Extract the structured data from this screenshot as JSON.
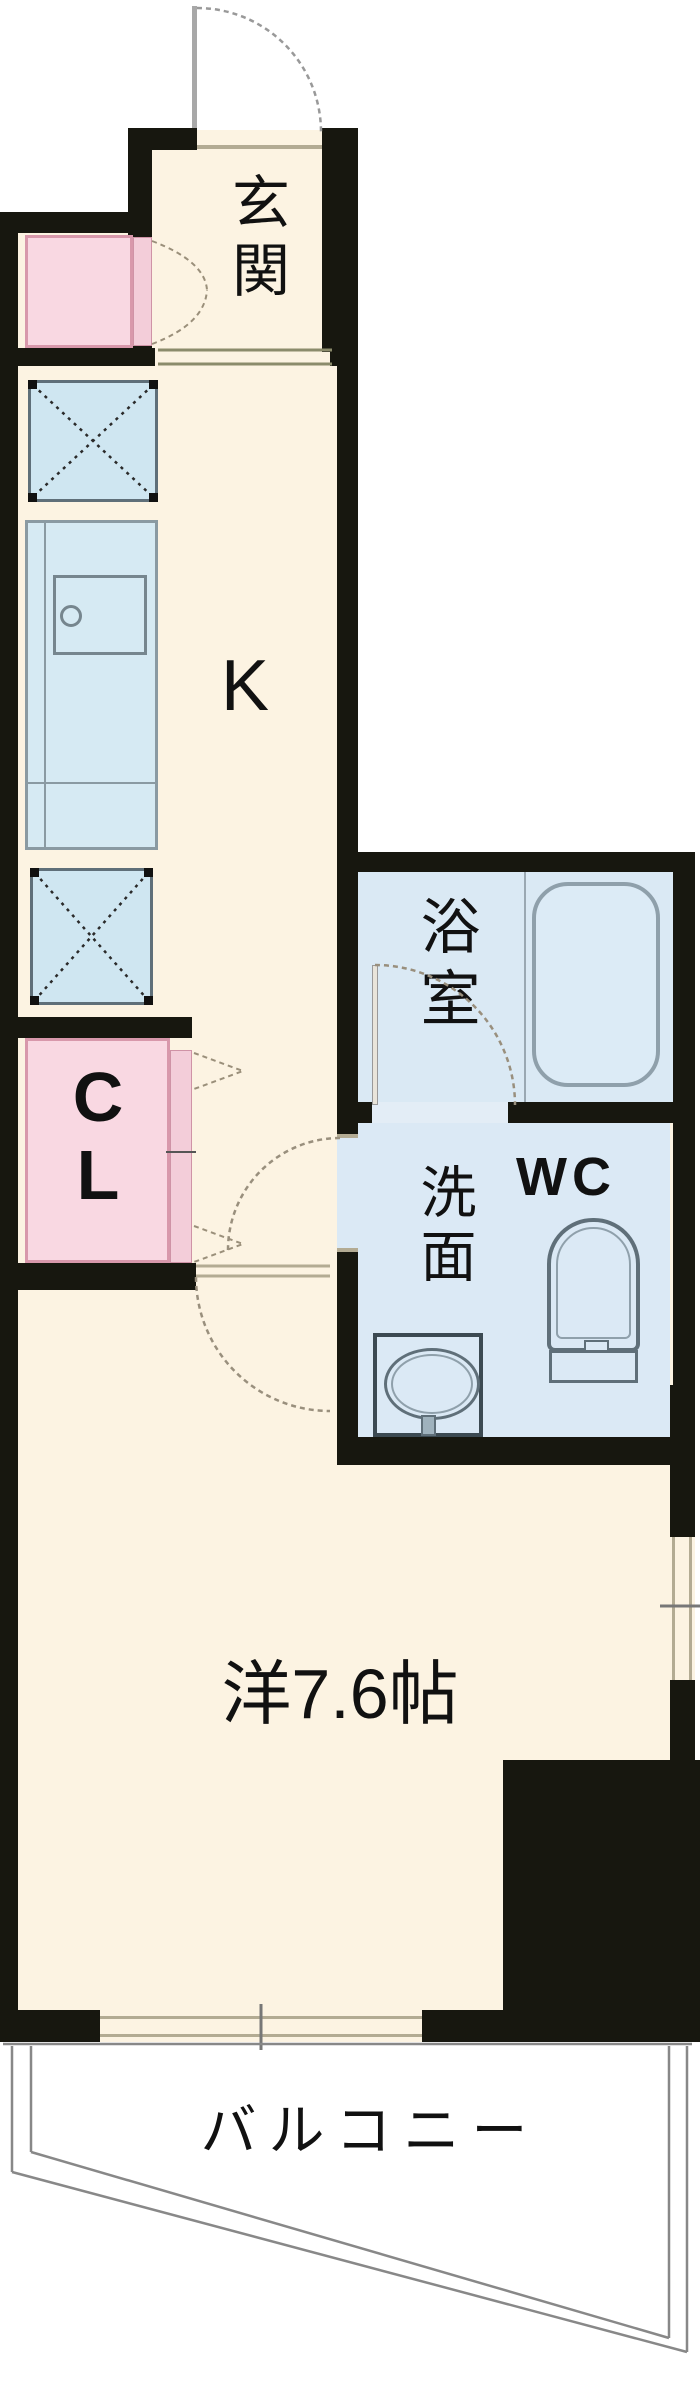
{
  "plan_title": "1K apartment floor plan",
  "rooms": {
    "entrance": {
      "label": "玄関"
    },
    "kitchen": {
      "label": "K"
    },
    "bath": {
      "label": "浴室"
    },
    "washroom": {
      "label": "洗面"
    },
    "wc": {
      "label": "WC"
    },
    "closet": {
      "letter_c": "C",
      "letter_l": "L"
    },
    "main": {
      "label": "洋7.6帖"
    },
    "balcony": {
      "label": "バルコニー"
    }
  },
  "colors": {
    "wall": "#17170f",
    "floor_cream": "#fcf3e2",
    "water_blue": "#d7e8f3",
    "closet_pink": "#f9d8e2",
    "pink_border": "#d898ab",
    "fixture_gray": "#5f6f79",
    "door_arc": "#998f7d",
    "window_tan": "#b3ab93",
    "balcony_line": "#888888"
  },
  "fixtures": {
    "bathtub": "bathtub",
    "toilet": "toilet",
    "vanity_basin": "wash basin",
    "kitchen_sink": "kitchen sink",
    "upper_x_space": "appliance space (X box)",
    "lower_x_space": "appliance space (X box)",
    "shoe_cabinet": "shoe cabinet"
  }
}
